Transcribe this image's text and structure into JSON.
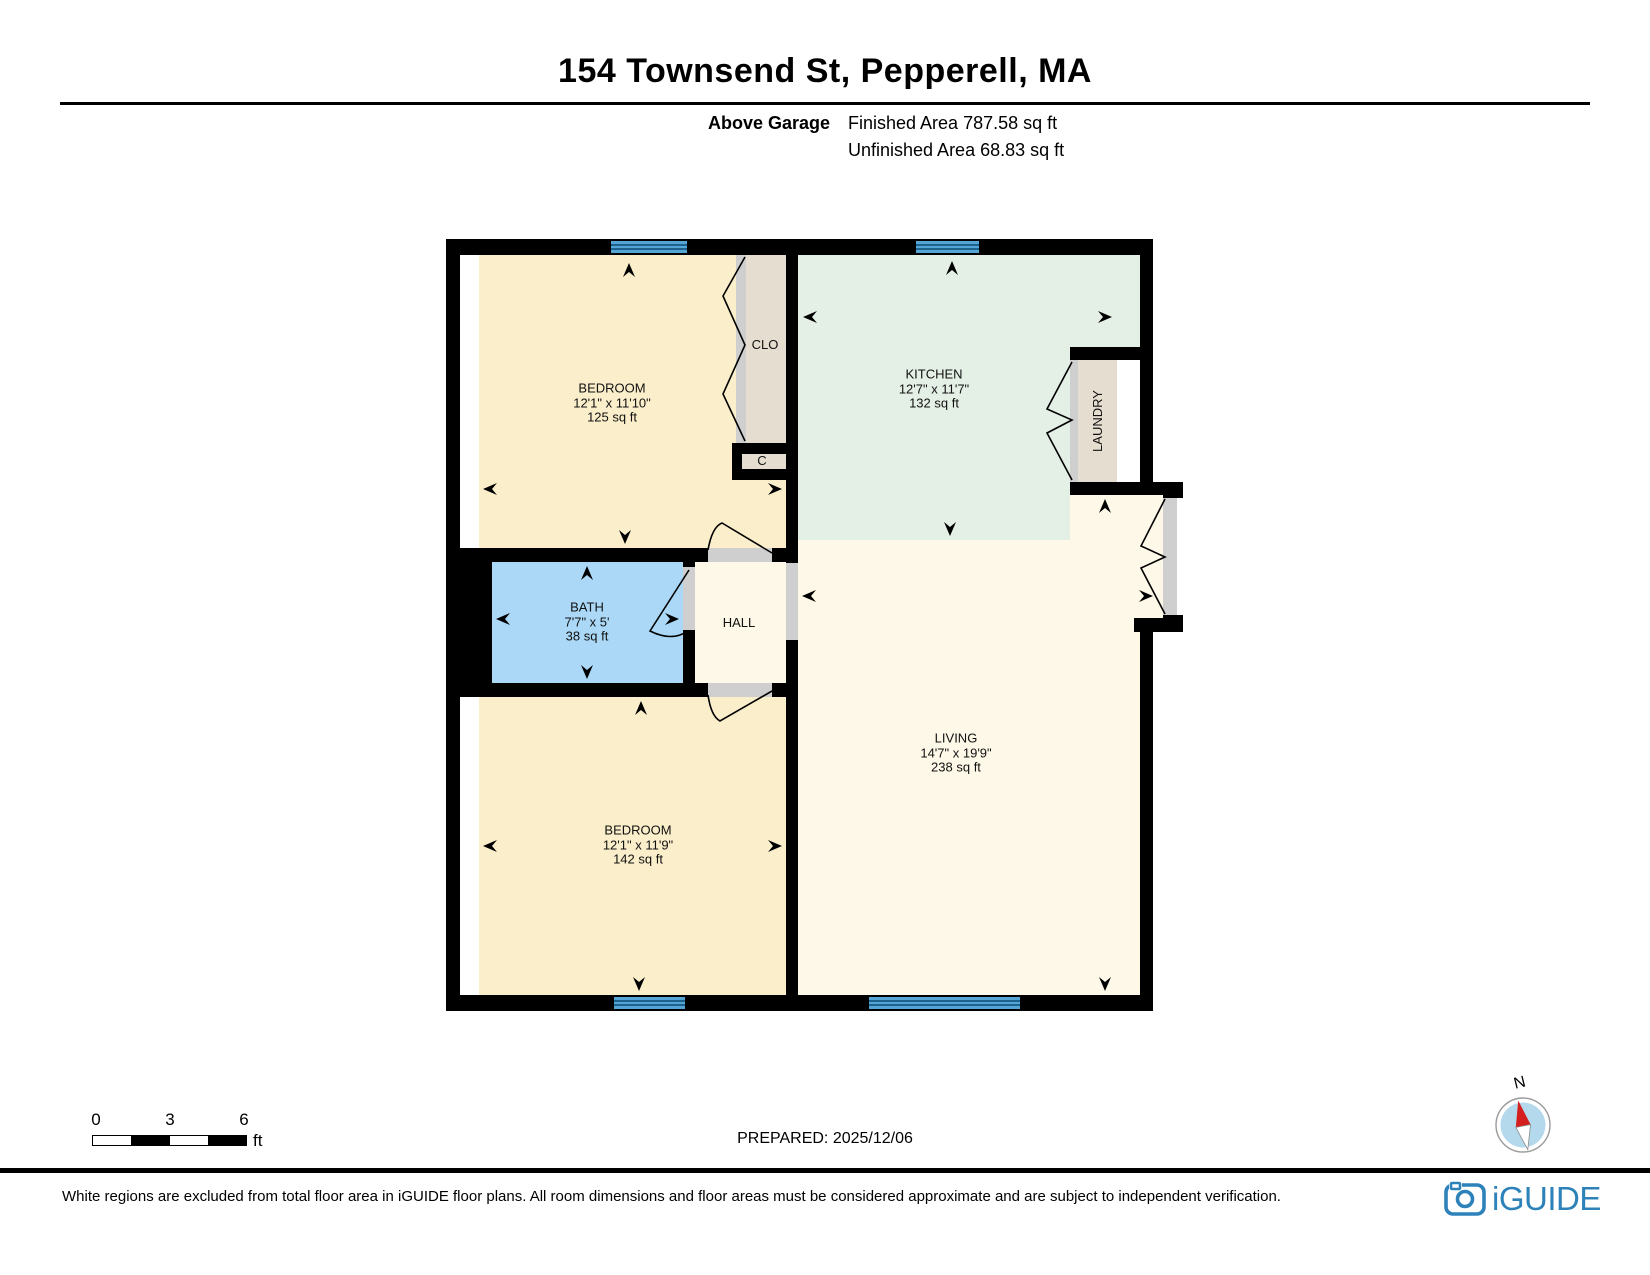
{
  "header": {
    "title": "154 Townsend St, Pepperell, MA",
    "floor_label": "Above Garage",
    "finished": "Finished Area 787.58 sq ft",
    "unfinished": "Unfinished Area 68.83 sq ft"
  },
  "rooms": {
    "bedroom_top": {
      "name": "BEDROOM",
      "dims": "12'1\" x 11'10\"",
      "area": "125 sq ft"
    },
    "kitchen": {
      "name": "KITCHEN",
      "dims": "12'7\" x 11'7\"",
      "area": "132 sq ft"
    },
    "bath": {
      "name": "BATH",
      "dims": "7'7\" x 5'",
      "area": "38 sq ft"
    },
    "hall": {
      "name": "HALL"
    },
    "living": {
      "name": "LIVING",
      "dims": "14'7\" x 19'9\"",
      "area": "238 sq ft"
    },
    "bedroom_bottom": {
      "name": "BEDROOM",
      "dims": "12'1\" x 11'9\"",
      "area": "142 sq ft"
    },
    "closet": {
      "name": "CLO"
    },
    "closet_small": {
      "name": "C"
    },
    "laundry": {
      "name": "LAUNDRY"
    }
  },
  "scale_bar": {
    "labels": [
      "0",
      "3",
      "6"
    ],
    "unit": "ft"
  },
  "compass": {
    "label": "N"
  },
  "footer": {
    "prepared": "PREPARED: 2025/12/06",
    "disclaimer": "White regions are excluded from total floor area in iGUIDE floor plans. All room dimensions and floor areas must be considered approximate and are subject to independent verification.",
    "brand": "iGUIDE"
  },
  "colors": {
    "room_cream": "#fbeecb",
    "room_light": "#fdf8e7",
    "kitchen_green": "#e4efe6",
    "bath_blue": "#aad8f6",
    "closet_tan": "#e5ddd0",
    "door_gray": "#cfcfcf",
    "window_blue": "#54a5d6",
    "window_line": "#1d618d",
    "brand_blue": "#2e82ba",
    "compass_blue": "#b5d9ec",
    "compass_red": "#d51f1f"
  }
}
